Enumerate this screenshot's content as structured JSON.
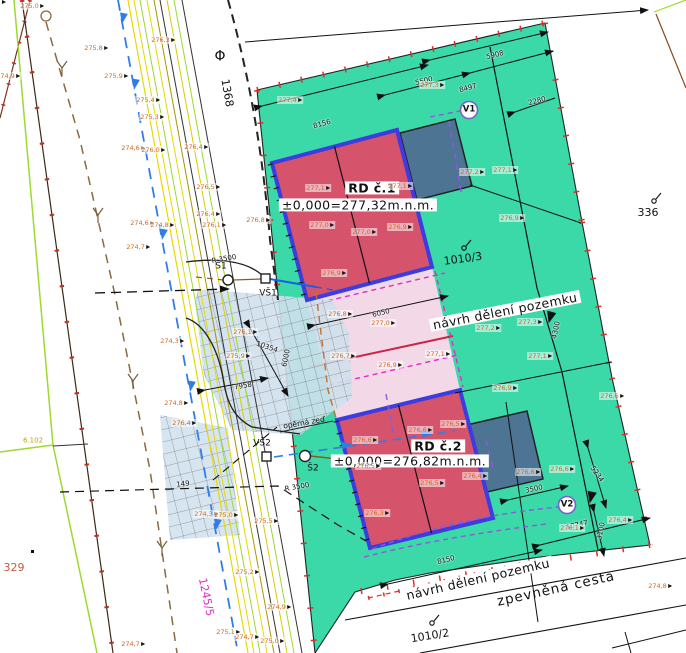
{
  "colors": {
    "parcel_green": "#3bd8a8",
    "house_red": "#d5536b",
    "house_border": "#3c3ce0",
    "garage_blue": "#4e7494",
    "pink_area": "#f3d9e7",
    "driveway_blue": "#cfe0ec",
    "magenta": "#e02cc8",
    "purple": "#8a5ad8",
    "orange_label": "#d2691e",
    "lime": "#9dd92f",
    "yellow": "#e6d800",
    "water_blue": "#1560e8",
    "dash_blue": "#2f7de8",
    "brown": "#8a5a20",
    "red_tick": "#d93025"
  },
  "houses": {
    "rd1": {
      "name": "RD č.1",
      "elevation": "±0,000=277,32m.n.m."
    },
    "rd2": {
      "name": "RD č.2",
      "elevation": "±0,000=276,82m.n.m."
    }
  },
  "annotations": {
    "navrh_deleni_1": "návrh dělení pozemku",
    "navrh_deleni_2": "návrh dělení pozemku",
    "zpevnena_cesta": "zpevněná cesta",
    "operna_zed": "opěrná zeď"
  },
  "parcels": {
    "phi": "Φ",
    "p1368": "1368",
    "p336": "336",
    "p1010_3": "1010/3",
    "p1010_2": "1010/2",
    "p329": "329",
    "p1245_5": "1245/5",
    "p6102": "6.102"
  },
  "utility_points": {
    "s1": "Š1",
    "s2": "Š2",
    "vs1": "VŠ1",
    "vs2": "VŠ2",
    "v1": "V1",
    "v2": "V2"
  },
  "dimensions": [
    {
      "text": "5908",
      "x": 495,
      "y": 55,
      "rot": -14
    },
    {
      "text": "8497",
      "x": 468,
      "y": 88,
      "rot": -14
    },
    {
      "text": "2280",
      "x": 537,
      "y": 101,
      "rot": -14
    },
    {
      "text": "5500",
      "x": 424,
      "y": 81,
      "rot": -14
    },
    {
      "text": "8156",
      "x": 322,
      "y": 124,
      "rot": -15
    },
    {
      "text": "6050",
      "x": 381,
      "y": 313,
      "rot": -13
    },
    {
      "text": "10354",
      "x": 267,
      "y": 347,
      "rot": 18
    },
    {
      "text": "6000",
      "x": 286,
      "y": 358,
      "rot": -78
    },
    {
      "text": "7958",
      "x": 243,
      "y": 386,
      "rot": -10
    },
    {
      "text": "5234",
      "x": 597,
      "y": 474,
      "rot": 55
    },
    {
      "text": "3500",
      "x": 534,
      "y": 489,
      "rot": -12
    },
    {
      "text": "10747",
      "x": 577,
      "y": 525,
      "rot": -13
    },
    {
      "text": "3100",
      "x": 601,
      "y": 531,
      "rot": -78
    },
    {
      "text": "8150",
      "x": 446,
      "y": 560,
      "rot": -14
    },
    {
      "text": "4300",
      "x": 556,
      "y": 330,
      "rot": -78
    },
    {
      "text": "149",
      "x": 183,
      "y": 484,
      "rot": -7
    },
    {
      "text": "R 3500",
      "x": 224,
      "y": 259,
      "rot": -10
    },
    {
      "text": "R 3500",
      "x": 297,
      "y": 487,
      "rot": -10
    }
  ],
  "spot_elevations": [
    {
      "text": "275,0",
      "x": 32,
      "y": 6
    },
    {
      "text": "275,8",
      "x": 96,
      "y": 48
    },
    {
      "text": "275,9",
      "x": 116,
      "y": 76
    },
    {
      "text": "274,9",
      "x": 8,
      "y": 76
    },
    {
      "text": "276,3",
      "x": 163,
      "y": 40
    },
    {
      "text": "275,4",
      "x": 148,
      "y": 100
    },
    {
      "text": "275,3",
      "x": 152,
      "y": 117
    },
    {
      "text": "274,6",
      "x": 133,
      "y": 148
    },
    {
      "text": "276,0",
      "x": 153,
      "y": 150
    },
    {
      "text": "276,4",
      "x": 196,
      "y": 147
    },
    {
      "text": "276,5",
      "x": 208,
      "y": 187
    },
    {
      "text": "276,4",
      "x": 208,
      "y": 214
    },
    {
      "text": "276,1",
      "x": 214,
      "y": 225
    },
    {
      "text": "274,6",
      "x": 142,
      "y": 223
    },
    {
      "text": "274,8",
      "x": 162,
      "y": 225
    },
    {
      "text": "274,7",
      "x": 138,
      "y": 247
    },
    {
      "text": "276,8",
      "x": 258,
      "y": 220
    },
    {
      "text": "276,1",
      "x": 245,
      "y": 332
    },
    {
      "text": "275,9",
      "x": 238,
      "y": 356
    },
    {
      "text": "274,3",
      "x": 172,
      "y": 341
    },
    {
      "text": "274,8",
      "x": 176,
      "y": 403
    },
    {
      "text": "276,4",
      "x": 184,
      "y": 423
    },
    {
      "text": "274,3",
      "x": 206,
      "y": 514
    },
    {
      "text": "275,0",
      "x": 226,
      "y": 515
    },
    {
      "text": "275,5",
      "x": 266,
      "y": 521
    },
    {
      "text": "274,7",
      "x": 133,
      "y": 644
    },
    {
      "text": "275,2",
      "x": 247,
      "y": 572
    },
    {
      "text": "274,9",
      "x": 279,
      "y": 607
    },
    {
      "text": "275,1",
      "x": 228,
      "y": 632
    },
    {
      "text": "274,7",
      "x": 247,
      "y": 637
    },
    {
      "text": "275,0",
      "x": 272,
      "y": 641
    },
    {
      "text": "274,8",
      "x": 660,
      "y": 586
    },
    {
      "text": "276,4",
      "x": 620,
      "y": 520
    },
    {
      "text": "276,1",
      "x": 572,
      "y": 528
    },
    {
      "text": "277,4",
      "x": 290,
      "y": 100
    },
    {
      "text": "277,3",
      "x": 432,
      "y": 85
    },
    {
      "text": "277,1",
      "x": 318,
      "y": 188
    },
    {
      "text": "277,1",
      "x": 400,
      "y": 186
    },
    {
      "text": "277,0",
      "x": 322,
      "y": 225
    },
    {
      "text": "277,0",
      "x": 364,
      "y": 232
    },
    {
      "text": "276,9",
      "x": 400,
      "y": 227
    },
    {
      "text": "276,9",
      "x": 334,
      "y": 273
    },
    {
      "text": "277,2",
      "x": 472,
      "y": 172
    },
    {
      "text": "277,1",
      "x": 505,
      "y": 170
    },
    {
      "text": "276,9",
      "x": 512,
      "y": 218
    },
    {
      "text": "277,2",
      "x": 488,
      "y": 328
    },
    {
      "text": "277,3",
      "x": 530,
      "y": 322
    },
    {
      "text": "277,1",
      "x": 438,
      "y": 354
    },
    {
      "text": "277,1",
      "x": 540,
      "y": 356
    },
    {
      "text": "276,9",
      "x": 505,
      "y": 388
    },
    {
      "text": "276,8",
      "x": 340,
      "y": 314
    },
    {
      "text": "277,0",
      "x": 383,
      "y": 323
    },
    {
      "text": "276,7",
      "x": 343,
      "y": 356
    },
    {
      "text": "276,9",
      "x": 390,
      "y": 365
    },
    {
      "text": "276,6",
      "x": 365,
      "y": 440
    },
    {
      "text": "276,6",
      "x": 420,
      "y": 430
    },
    {
      "text": "276,5",
      "x": 453,
      "y": 424
    },
    {
      "text": "276,5",
      "x": 368,
      "y": 466
    },
    {
      "text": "276,5",
      "x": 432,
      "y": 483
    },
    {
      "text": "276,4",
      "x": 475,
      "y": 476
    },
    {
      "text": "276,3",
      "x": 377,
      "y": 513
    },
    {
      "text": "276,6",
      "x": 528,
      "y": 472
    },
    {
      "text": "276,6",
      "x": 562,
      "y": 469
    },
    {
      "text": "276,6",
      "x": 612,
      "y": 396
    }
  ]
}
